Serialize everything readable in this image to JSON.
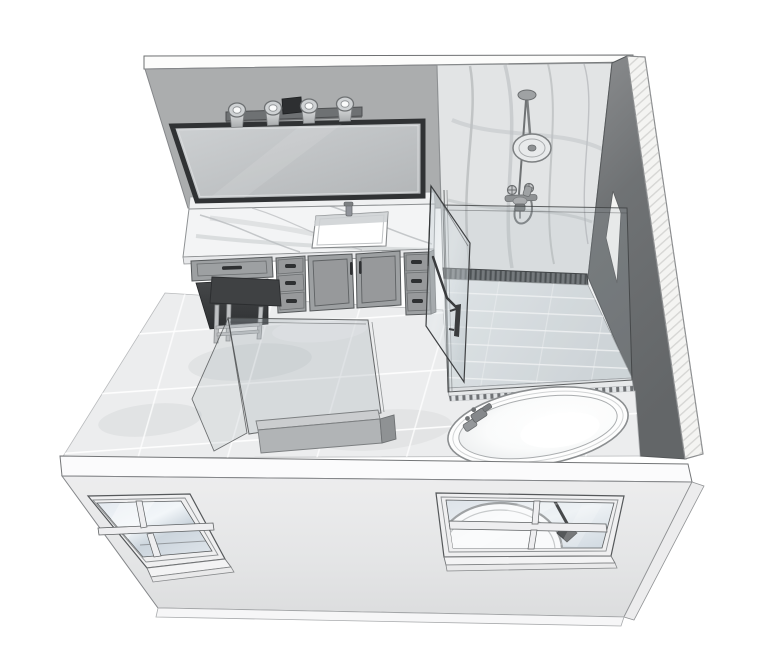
{
  "scene": {
    "title": "bathroom-3d-axonometric-view",
    "render_style": "sketchup-line-render",
    "view": "bird's-eye cutaway of master bathroom"
  },
  "colors": {
    "line": "#4d4f51",
    "wall_top": "#fcfcfb",
    "wall_gray": "#abadae",
    "wall_marble": "#e2e4e5",
    "wall_dark": "#717476",
    "wall_outer": "#f4f4f2",
    "floor_base": "#ecedee",
    "shower_floor": "#e2e6e9",
    "accent_strip": "#6b6e71",
    "accent_dash": "#3b3e40",
    "cabinet": "#9da0a2",
    "cabinet_panel": "#97999b",
    "cabinet_handle": "#2e3032",
    "counter_marble": "#f3f4f5",
    "backsplash_marble": "#eff0f1",
    "mirror_frame": "#303234",
    "mirror_glass": "#c3c6c8",
    "light_bar": "#6e7173",
    "light_plate": "#2d2f31",
    "metal": "#90939a",
    "stool_dark": "#3f4143",
    "stool_leg": "#bfc1c3",
    "sink_white": "#ffffff",
    "glass_edge": "#3f4143",
    "tub_white": "#fdfdfd",
    "tub_outline": "#8b8e90",
    "pony_cap": "#cbcdcf",
    "pony_face": "#b1b4b6",
    "pony_side": "#8f9294",
    "front_wall_band": "#fbfbfc",
    "window_frame": "#efeff0",
    "window_glass_tint": "#dfe5eb",
    "window_diamond": "#55585a",
    "niche_fill": "#f4f4f2",
    "end_panel": "#85888a",
    "curb": "#e7e9ea"
  },
  "fixtures": {
    "vanity_light_count": 4,
    "window_count": 2,
    "items": [
      "back-wall",
      "vanity-mirror",
      "vanity-light-fixture",
      "undermount-sink",
      "faucet",
      "marble-countertop",
      "makeup-desk",
      "vanity-stool",
      "drawer-stack-left",
      "sink-cabinet-doors",
      "drawer-stack-right",
      "shower-marble-wall",
      "mosaic-accent-border",
      "shower-floor",
      "rain-shower-head",
      "hand-shower",
      "shower-valve",
      "shower-glass-panel",
      "shower-glass-door",
      "door-handle",
      "right-wall",
      "wall-niche",
      "freestanding-bathtub",
      "tub-filler",
      "toilet-partition-glass",
      "partition-pony-wall",
      "front-wall",
      "window-left",
      "window-right",
      "tile-floor"
    ]
  }
}
